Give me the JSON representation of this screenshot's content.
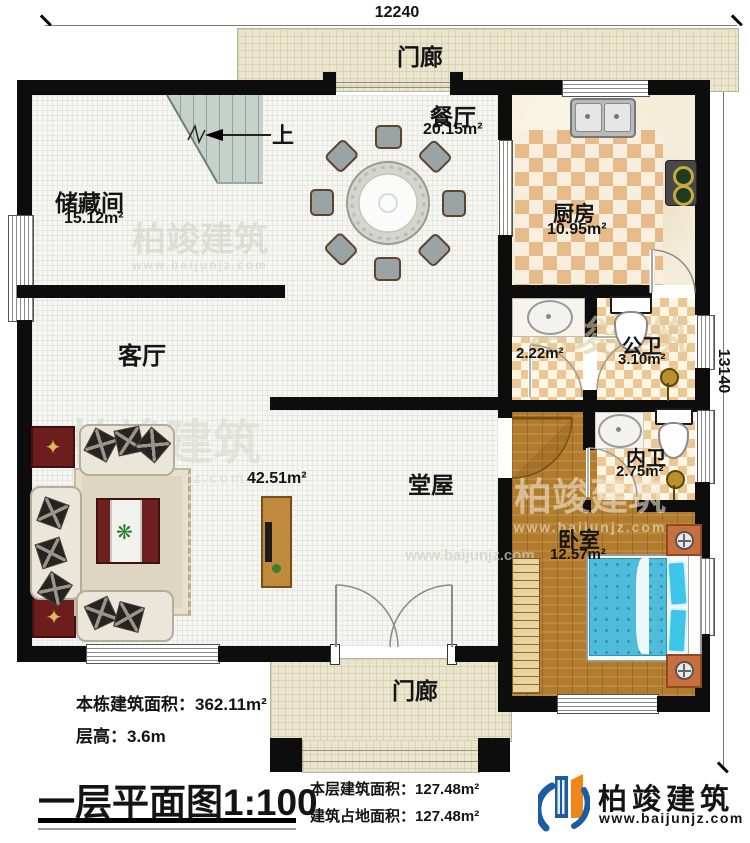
{
  "dimensions": {
    "top": "12240",
    "right": "13140"
  },
  "rooms": {
    "porch_top": {
      "name": "门廊"
    },
    "dining": {
      "name": "餐厅",
      "area": "20.15m²"
    },
    "kitchen": {
      "name": "厨房",
      "area": "10.95m²"
    },
    "storage": {
      "name": "储藏间",
      "area": "15.12m²"
    },
    "living": {
      "name": "客厅"
    },
    "hall": {
      "name": "堂屋",
      "area": "42.51m²"
    },
    "wash_area": {
      "area": "2.22m²"
    },
    "public_bath": {
      "name": "公卫",
      "area": "3.10m²"
    },
    "private_bath": {
      "name": "内卫",
      "area": "2.75m²"
    },
    "bedroom": {
      "name": "卧室",
      "area": "12.57m²"
    },
    "porch_bottom": {
      "name": "门廊"
    }
  },
  "stairs": {
    "up_label": "上"
  },
  "info": {
    "total_area_label": "本栋建筑面积：",
    "total_area_value": "362.11m²",
    "floor_height_label": "层高：",
    "floor_height_value": "3.6m",
    "title": "一层平面图",
    "scale": "1:100",
    "floor_area_label": "本层建筑面积：",
    "floor_area_value": "127.48m²",
    "footprint_label": "建筑占地面积：",
    "footprint_value": "127.48m²"
  },
  "brand": {
    "name": "柏竣建筑",
    "website": "www.baijunjz.com"
  }
}
